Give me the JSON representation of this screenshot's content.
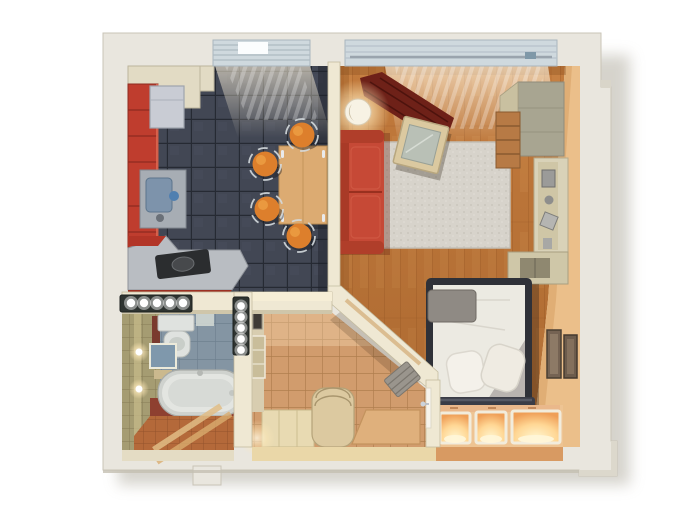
{
  "meta": {
    "kind": "3d-floor-plan-render",
    "description": "Top-down 3D cutaway render of a one-room apartment",
    "background": "#ffffff"
  },
  "palette": {
    "wall_outer": "#e9e6de",
    "wall_outer_shade": "#d2cec2",
    "wall_inner_top": "#efe8d3",
    "wall_peach": "#ebbf8a",
    "kitchen_tile": "#424754",
    "kitchen_grout": "#262a33",
    "kitchen_cabinet_red": "#bf3d2e",
    "counter_gray": "#b9bdc2",
    "cooktop_dark": "#2b2d2f",
    "fridge_gray": "#c9ccd4",
    "sink_steel": "#a7adb4",
    "dining_table_wood": "#dcab72",
    "stool_orange": "#dd7f2c",
    "wood_floor": "#c27a3c",
    "wood_seam": "#a05c28",
    "sofa_red": "#c64936",
    "sofa_red_dark": "#a93a27",
    "rug_gray": "#d7d3cb",
    "coffee_table_wood": "#dbc9a0",
    "coffee_table_glass": "#b9c0b6",
    "curtain_red": "#6e2118",
    "wardrobe_khaki": "#a8a591",
    "shelf_beige": "#d9d2b8",
    "bed_frame_dark": "#2f3138",
    "mattress_gray": "#b9b4b0",
    "bedding_white": "#eceae2",
    "pillow_white": "#f4f1ea",
    "throw_gray": "#8f8a84",
    "footboard_dark": "#3a3c46",
    "podium_peach": "#eec493",
    "niche_frame": "#f2ecdc",
    "hall_tile": "#d19c6d",
    "hall_grout": "#b07e4e",
    "bench_beige": "#dcc9a0",
    "shoe_cabinet": "#e8dab2",
    "bath_wall_olive": "#a59c72",
    "bath_tile_blue": "#8495a3",
    "bath_floor_terracotta": "#b4693a",
    "bath_floor_red": "#8e4030",
    "tub_white": "#e3e5e1",
    "toilet_white": "#dfe2df",
    "spot_panel_dark": "#2f3431",
    "window_blind": "#cfd9de",
    "doormat": "#dfb07c"
  },
  "rooms": [
    {
      "id": "kitchen-dining",
      "label": "Kitchen / dining room",
      "floor": "dark gray ceramic tile",
      "items": [
        "red kitchen cabinet run",
        "refrigerator",
        "steel sink counter",
        "red cooktop counter",
        "wood dining table",
        "orange stool x4",
        "window with blinds"
      ]
    },
    {
      "id": "living-room",
      "label": "Living room",
      "floor": "wood plank",
      "items": [
        "red sofa",
        "glowing floor lamp",
        "gray area rug",
        "tilted coffee table",
        "window with dark red curtain",
        "wardrobe",
        "shelving column",
        "low open cabinet"
      ]
    },
    {
      "id": "bedroom",
      "label": "Sleeping area",
      "floor": "wood plank with podium",
      "items": [
        "double bed with dark frame",
        "white duvet",
        "pillows x2",
        "gray throw",
        "footboard bench",
        "podium with 3 illuminated niches",
        "wall art x2"
      ]
    },
    {
      "id": "hallway",
      "label": "Entry hall",
      "floor": "terracotta square tile",
      "items": [
        "upholstered bench",
        "shoe cabinet",
        "wall mirror",
        "interior door with handle",
        "doormat",
        "recessed spotlight strips"
      ]
    },
    {
      "id": "bathroom",
      "label": "Bathroom",
      "floor": "terracotta mosaic tile",
      "items": [
        "bathtub",
        "toilet",
        "mirror cabinet",
        "wall sconce x2",
        "blue-gray tiled wall",
        "olive tiled wall"
      ]
    }
  ]
}
